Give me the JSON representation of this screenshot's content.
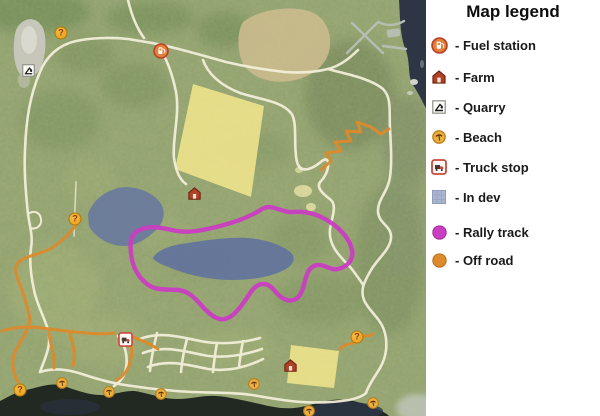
{
  "legend": {
    "title": "Map legend",
    "items": [
      {
        "type": "fuel",
        "label": "- Fuel station"
      },
      {
        "type": "farm",
        "label": "- Farm"
      },
      {
        "type": "quarry",
        "label": "- Quarry"
      },
      {
        "type": "beach",
        "label": "- Beach"
      },
      {
        "type": "truckstop",
        "label": "- Truck stop"
      },
      {
        "type": "indev",
        "label": "- In dev"
      },
      {
        "type": "rally",
        "label": "- Rally track"
      },
      {
        "type": "offroad",
        "label": "- Off road"
      }
    ]
  },
  "map": {
    "question_glyph": "?",
    "markers": [
      {
        "type": "question",
        "x": 61,
        "y": 33
      },
      {
        "type": "quarry",
        "x": 22,
        "y": 64
      },
      {
        "type": "fuel",
        "x": 153,
        "y": 43
      },
      {
        "type": "farm",
        "x": 187,
        "y": 186
      },
      {
        "type": "question",
        "x": 75,
        "y": 219
      },
      {
        "type": "truckstop",
        "x": 118,
        "y": 332
      },
      {
        "type": "question",
        "x": 357,
        "y": 337
      },
      {
        "type": "farm",
        "x": 283,
        "y": 358
      },
      {
        "type": "question",
        "x": 20,
        "y": 390
      },
      {
        "type": "beach",
        "x": 56,
        "y": 377
      },
      {
        "type": "beach",
        "x": 103,
        "y": 386
      },
      {
        "type": "beach",
        "x": 155,
        "y": 388
      },
      {
        "type": "beach",
        "x": 248,
        "y": 378
      },
      {
        "type": "beach",
        "x": 303,
        "y": 405
      },
      {
        "type": "beach",
        "x": 367,
        "y": 397
      }
    ]
  },
  "colors": {
    "terrain_green": "#95a471",
    "forest_green": "#6d8852",
    "road_cream": "#f4f0dc",
    "road_gray": "#b6beb2",
    "field_yellow": "#eadf8b",
    "field_tan": "#c8b98c",
    "quarry_gray": "#c6c6ba",
    "water_navy": "#2e3645",
    "water_dark": "#222922",
    "in_dev_blue": "#8e9cc0",
    "in_dev_swatch": "#aab4cf",
    "rally_magenta": "#ca3dc2",
    "offroad_orange": "#dc8a2c"
  }
}
